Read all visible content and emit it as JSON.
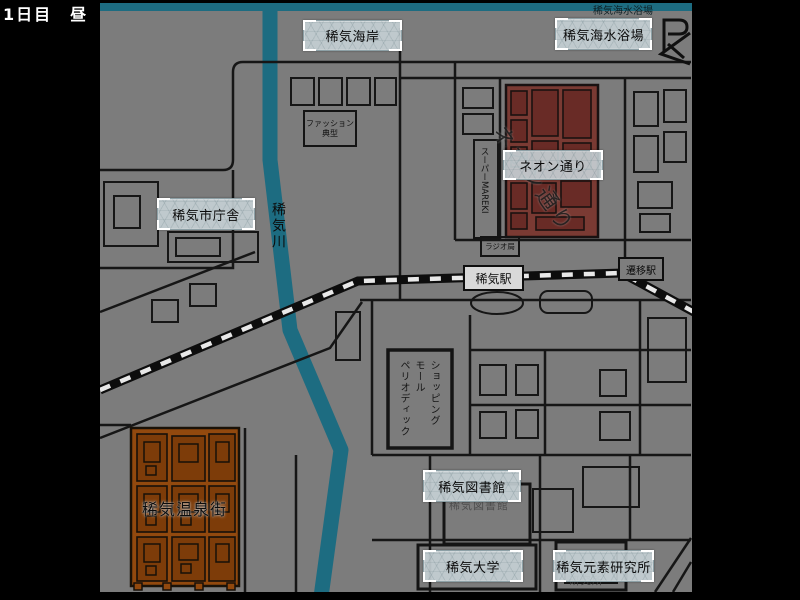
{
  "hud": {
    "day_label": "1日目　昼"
  },
  "colors": {
    "background": "#000000",
    "map_ground": "#7c7c7c",
    "water": "#1d6c81",
    "road": "#161616",
    "neon_district_fill": "#7a3a33",
    "neon_building_fill": "#692b26",
    "onsen_district_fill": "#92490e",
    "onsen_building_fill": "#7d3c09",
    "button_bg": "#c7d2d6",
    "station_box_bg": "#d9d9d9"
  },
  "buttons": {
    "coast": {
      "label": "稀気海岸"
    },
    "beach": {
      "label": "稀気海水浴場"
    },
    "neon": {
      "label": "ネオン通り"
    },
    "city_hall": {
      "label": "稀気市庁舎"
    },
    "library": {
      "label": "稀気図書館"
    },
    "university": {
      "label": "稀気大学"
    },
    "research_lab": {
      "label": "稀気元素研究所"
    }
  },
  "map_labels": {
    "beach_shore_top": "稀気海水浴場",
    "fashion_store_line1": "ファッション",
    "fashion_store_line2": "典型",
    "supermarket": "スーパーMAREKI",
    "neon_street_road": "ネオン通り",
    "radio_station": "ラジオ局",
    "kiki_station": "稀気駅",
    "transfer_station": "遷移駅",
    "river": "稀気川",
    "shopping_mall": "ショッピング\nモール\nペリオディック",
    "library_building": "稀気図書館",
    "research_building": "研究所",
    "onsen_town": "稀気温泉街"
  }
}
